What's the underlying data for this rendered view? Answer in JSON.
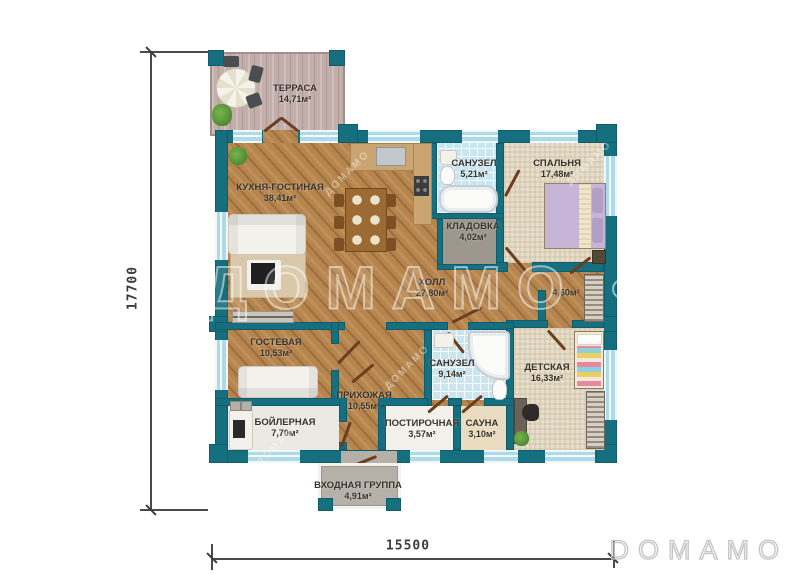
{
  "plan": {
    "watermark": "ДОМАМО",
    "logo": "DOMAMO",
    "dimensions": {
      "width_mm": "15500",
      "height_mm": "17700"
    },
    "rooms": [
      {
        "id": "terrace",
        "name": "ТЕРРАСА",
        "area": "14,71м²"
      },
      {
        "id": "kitchen-living",
        "name": "КУХНЯ-ГОСТИНАЯ",
        "area": "38,41м²"
      },
      {
        "id": "bathroom-1",
        "name": "САНУЗЕЛ",
        "area": "5,21м²"
      },
      {
        "id": "bedroom",
        "name": "СПАЛЬНЯ",
        "area": "17,48м²"
      },
      {
        "id": "storage",
        "name": "КЛАДОВКА",
        "area": "4,02м²"
      },
      {
        "id": "hall",
        "name": "ХОЛЛ",
        "area": "27,80м²"
      },
      {
        "id": "wardrobe",
        "name": "",
        "area": "4,60м²"
      },
      {
        "id": "guest-room",
        "name": "ГОСТЕВАЯ",
        "area": "10,53м²"
      },
      {
        "id": "bathroom-2",
        "name": "САНУЗЕЛ",
        "area": "9,14м²"
      },
      {
        "id": "kids-room",
        "name": "ДЕТСКАЯ",
        "area": "16,33м²"
      },
      {
        "id": "entry-hall",
        "name": "ПРИХОЖАЯ",
        "area": "10,55м²"
      },
      {
        "id": "boiler-room",
        "name": "БОЙЛЕРНАЯ",
        "area": "7,70м²"
      },
      {
        "id": "laundry",
        "name": "ПОСТИРОЧНАЯ",
        "area": "3,57м²"
      },
      {
        "id": "sauna",
        "name": "САУНА",
        "area": "3,10м²"
      },
      {
        "id": "entrance",
        "name": "ВХОДНАЯ ГРУППА",
        "area": "4,91м²"
      }
    ],
    "colors": {
      "wall": "#156f7e",
      "window": "#aed9e6",
      "wood": "#b5854f",
      "tile": "#c9e5ef",
      "carpet": "#e6decb",
      "door_leaf": "#6b3e1f"
    }
  }
}
